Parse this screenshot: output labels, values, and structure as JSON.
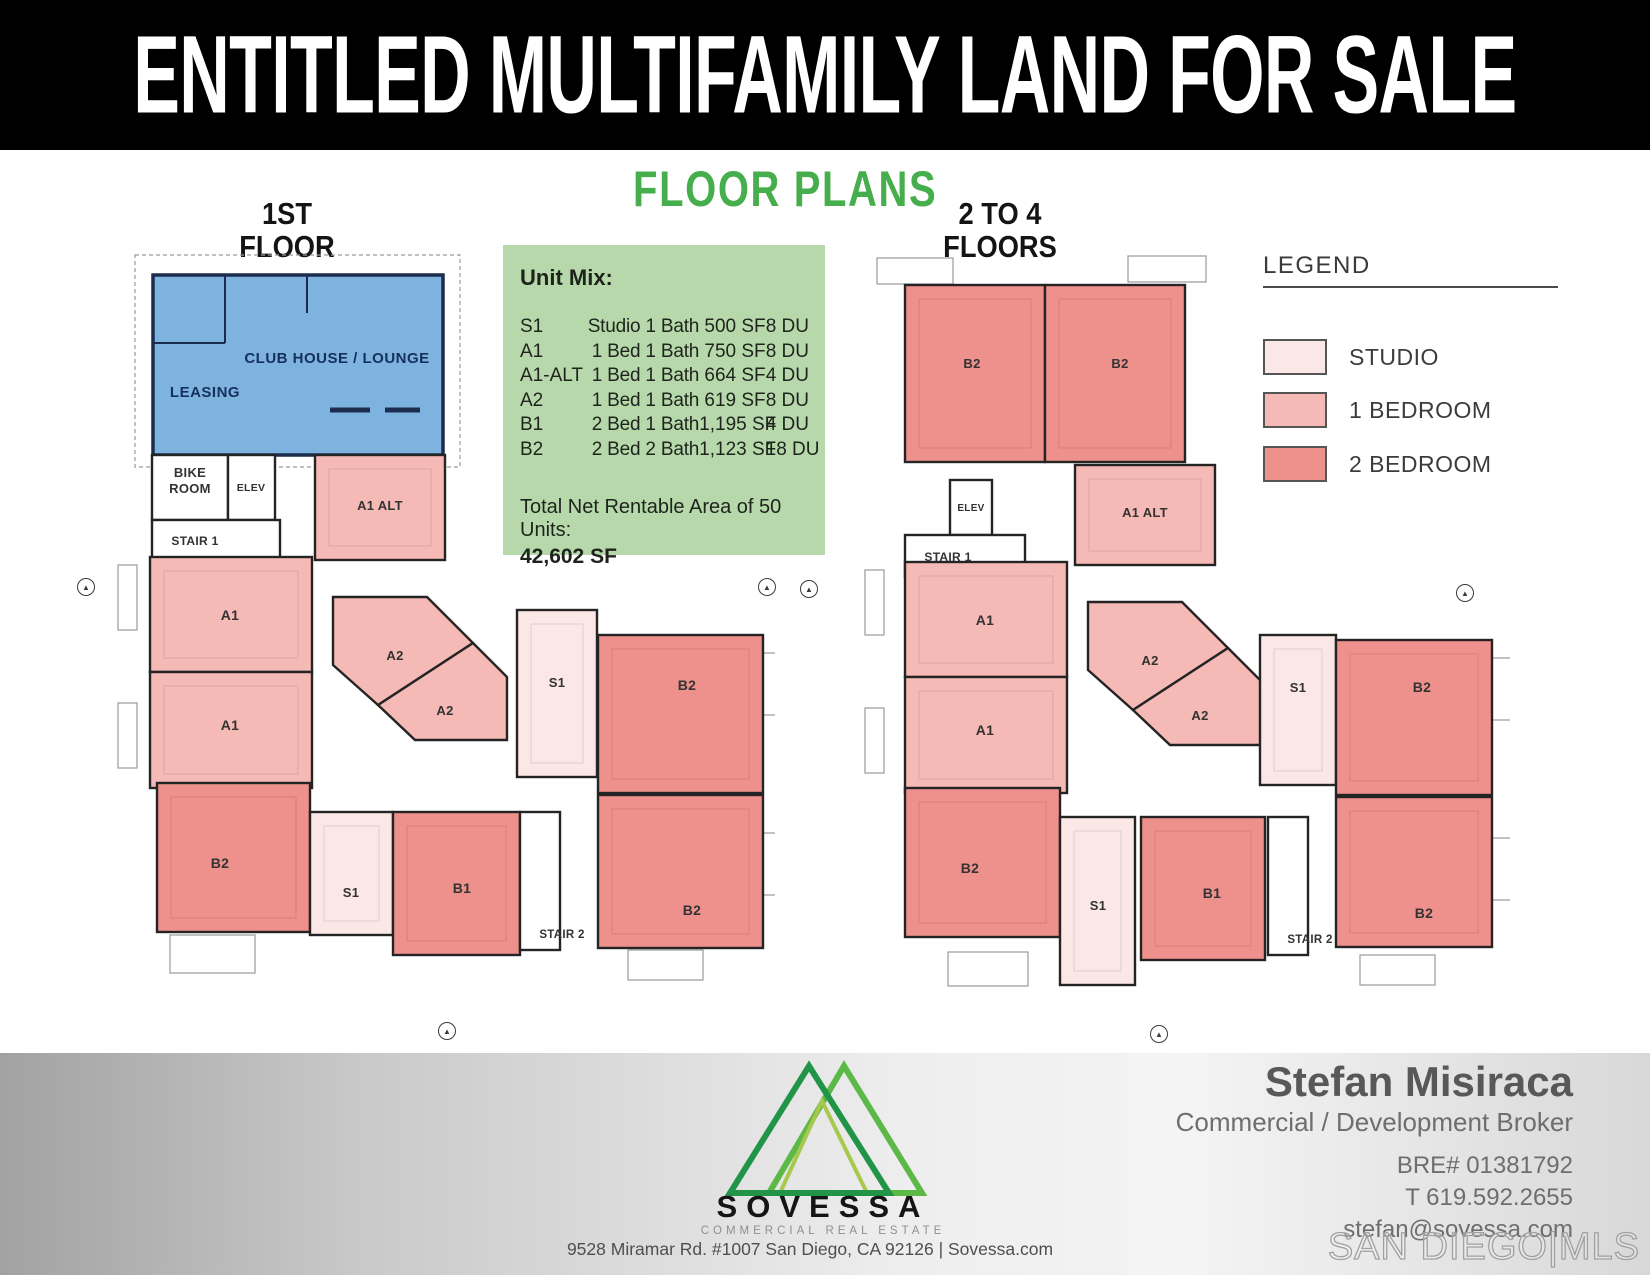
{
  "header": {
    "title": "ENTITLED MULTIFAMILY LAND FOR SALE"
  },
  "section_title": "FLOOR PLANS",
  "colors": {
    "banner_bg": "#000000",
    "banner_text": "#ffffff",
    "heading_green": "#47ae4d",
    "unit_mix_bg": "#b6d8ab",
    "studio": "#fbe7e5",
    "one_bed": "#f5b9b6",
    "two_bed": "#ee908c",
    "amenity": "#7fb3df",
    "wall": "#242424",
    "amenity_wall": "#1b2c4e",
    "common": "#ffffff"
  },
  "unit_mix": {
    "heading": "Unit Mix:",
    "rows": [
      {
        "code": "S1",
        "desc": "Studio 1 Bath",
        "sf": "500 SF",
        "du": "8 DU"
      },
      {
        "code": "A1",
        "desc": "1 Bed 1 Bath",
        "sf": "750 SF",
        "du": "8 DU"
      },
      {
        "code": "A1-ALT",
        "desc": "1 Bed 1 Bath",
        "sf": "664 SF",
        "du": "4 DU"
      },
      {
        "code": "A2",
        "desc": "1 Bed 1 Bath",
        "sf": "619 SF",
        "du": "8 DU"
      },
      {
        "code": "B1",
        "desc": "2 Bed 1 Bath",
        "sf": "1,195 SF",
        "du": "4 DU"
      },
      {
        "code": "B2",
        "desc": "2 Bed 2 Bath",
        "sf": "1,123 SF",
        "du": "18 DU"
      }
    ],
    "total_label": "Total Net Rentable Area of 50 Units:",
    "total_value": "42,602 SF"
  },
  "legend": {
    "title": "LEGEND",
    "items": [
      {
        "label": "STUDIO",
        "color": "#fbe7e5",
        "top": 51
      },
      {
        "label": "1 BEDROOM",
        "color": "#f5b9b6",
        "top": 104
      },
      {
        "label": "2 BEDROOM",
        "color": "#ee908c",
        "top": 158
      }
    ]
  },
  "plans": [
    {
      "id": "plan-first",
      "title_line1": "1ST",
      "title_line2": "FLOOR",
      "left": 75,
      "top": 235,
      "width": 700,
      "height": 770,
      "deco": [
        {
          "x": 60,
          "y": 20,
          "w": 325,
          "h": 212,
          "dashed": true
        },
        {
          "x": 43,
          "y": 330,
          "w": 19,
          "h": 65
        },
        {
          "x": 43,
          "y": 468,
          "w": 19,
          "h": 65
        },
        {
          "x": 688,
          "y": 418,
          "w": 22,
          "h": 62
        },
        {
          "x": 688,
          "y": 598,
          "w": 22,
          "h": 62
        },
        {
          "x": 95,
          "y": 700,
          "w": 85,
          "h": 38
        },
        {
          "x": 553,
          "y": 715,
          "w": 75,
          "h": 30
        }
      ],
      "lines": [
        {
          "x1": 150,
          "y1": 40,
          "x2": 150,
          "y2": 108
        },
        {
          "x1": 78,
          "y1": 108,
          "x2": 150,
          "y2": 108
        },
        {
          "x1": 232,
          "y1": 40,
          "x2": 232,
          "y2": 78
        },
        {
          "x1": 255,
          "y1": 175,
          "x2": 295,
          "y2": 175,
          "w": 5
        },
        {
          "x1": 310,
          "y1": 175,
          "x2": 345,
          "y2": 175,
          "w": 5
        }
      ],
      "texts": [
        {
          "t": "LEASING",
          "x": 130,
          "y": 162,
          "cls": "amenity",
          "fs": 15
        },
        {
          "t": "CLUB HOUSE / LOUNGE",
          "x": 262,
          "y": 128,
          "cls": "amenity",
          "fs": 15
        },
        {
          "t": "STAIR 2",
          "x": 487,
          "y": 703,
          "fs": 11.5
        }
      ],
      "rooms": [
        {
          "type": "amenity",
          "x": 78,
          "y": 40,
          "w": 290,
          "h": 180
        },
        {
          "type": "common",
          "x": 77,
          "y": 220,
          "w": 76,
          "h": 65,
          "label": "BIKE|ROOM",
          "fs": 13,
          "lx": 115,
          "ly": 242
        },
        {
          "type": "common",
          "x": 153,
          "y": 220,
          "w": 47,
          "h": 65,
          "label": "ELEV",
          "fs": 10.5,
          "lx": 176,
          "ly": 256
        },
        {
          "type": "common",
          "x": 77,
          "y": 285,
          "w": 128,
          "h": 40,
          "label": "STAIR 1",
          "fs": 12,
          "lx": 120,
          "ly": 310
        },
        {
          "type": "one_bed",
          "x": 240,
          "y": 220,
          "w": 130,
          "h": 105,
          "label": "A1 ALT",
          "fs": 13,
          "lx": 305,
          "ly": 275
        },
        {
          "type": "one_bed",
          "x": 75,
          "y": 322,
          "w": 162,
          "h": 115,
          "label": "A1",
          "fs": 14,
          "lx": 155,
          "ly": 385
        },
        {
          "type": "one_bed",
          "x": 75,
          "y": 437,
          "w": 162,
          "h": 116,
          "label": "A1",
          "fs": 14,
          "lx": 155,
          "ly": 495
        },
        {
          "type": "one_bed",
          "points": "258,362 352,362 398,408 303,470 258,430",
          "label": "A2",
          "fs": 13,
          "lx": 320,
          "ly": 425
        },
        {
          "type": "one_bed",
          "points": "398,408 432,442 432,505 340,505 303,470",
          "label": "A2",
          "fs": 13,
          "lx": 370,
          "ly": 480
        },
        {
          "type": "studio",
          "x": 442,
          "y": 375,
          "w": 80,
          "h": 167,
          "label": "S1",
          "fs": 13,
          "lx": 482,
          "ly": 452
        },
        {
          "type": "two_bed",
          "x": 523,
          "y": 400,
          "w": 165,
          "h": 158,
          "label": "B2",
          "fs": 14,
          "lx": 612,
          "ly": 455
        },
        {
          "type": "two_bed",
          "x": 523,
          "y": 560,
          "w": 165,
          "h": 153,
          "label": "B2",
          "fs": 14,
          "lx": 617,
          "ly": 680
        },
        {
          "type": "two_bed",
          "x": 82,
          "y": 548,
          "w": 153,
          "h": 149,
          "label": "B2",
          "fs": 14,
          "lx": 145,
          "ly": 633
        },
        {
          "type": "studio",
          "x": 235,
          "y": 577,
          "w": 83,
          "h": 123,
          "label": "S1",
          "fs": 13,
          "lx": 276,
          "ly": 662
        },
        {
          "type": "two_bed",
          "x": 318,
          "y": 577,
          "w": 127,
          "h": 143,
          "label": "B1",
          "fs": 14,
          "lx": 387,
          "ly": 658
        },
        {
          "type": "common",
          "x": 445,
          "y": 577,
          "w": 40,
          "h": 138
        }
      ]
    },
    {
      "id": "plan-upper",
      "title_line1": "2 TO 4",
      "title_line2": "FLOORS",
      "left": 820,
      "top": 240,
      "width": 690,
      "height": 770,
      "deco": [
        {
          "x": 57,
          "y": 18,
          "w": 76,
          "h": 26
        },
        {
          "x": 308,
          "y": 16,
          "w": 78,
          "h": 26
        },
        {
          "x": 45,
          "y": 330,
          "w": 19,
          "h": 65
        },
        {
          "x": 45,
          "y": 468,
          "w": 19,
          "h": 65
        },
        {
          "x": 672,
          "y": 418,
          "w": 22,
          "h": 62
        },
        {
          "x": 672,
          "y": 598,
          "w": 22,
          "h": 62
        },
        {
          "x": 128,
          "y": 712,
          "w": 80,
          "h": 34
        },
        {
          "x": 540,
          "y": 715,
          "w": 75,
          "h": 30
        }
      ],
      "lines": [],
      "texts": [
        {
          "t": "STAIR 2",
          "x": 490,
          "y": 703,
          "fs": 11.5
        }
      ],
      "rooms": [
        {
          "type": "two_bed",
          "x": 85,
          "y": 45,
          "w": 140,
          "h": 177,
          "label": "B2",
          "fs": 13,
          "lx": 152,
          "ly": 128
        },
        {
          "type": "two_bed",
          "x": 225,
          "y": 45,
          "w": 140,
          "h": 177,
          "label": "B2",
          "fs": 13,
          "lx": 300,
          "ly": 128
        },
        {
          "type": "common",
          "x": 130,
          "y": 240,
          "w": 42,
          "h": 55,
          "label": "ELEV",
          "fs": 10,
          "lx": 151,
          "ly": 271
        },
        {
          "type": "common",
          "x": 85,
          "y": 295,
          "w": 120,
          "h": 42,
          "label": "STAIR 1",
          "fs": 12,
          "lx": 128,
          "ly": 321
        },
        {
          "type": "one_bed",
          "x": 255,
          "y": 225,
          "w": 140,
          "h": 100,
          "label": "A1 ALT",
          "fs": 13,
          "lx": 325,
          "ly": 277
        },
        {
          "type": "one_bed",
          "x": 85,
          "y": 322,
          "w": 162,
          "h": 115,
          "label": "A1",
          "fs": 14,
          "lx": 165,
          "ly": 385
        },
        {
          "type": "one_bed",
          "x": 85,
          "y": 437,
          "w": 162,
          "h": 116,
          "label": "A1",
          "fs": 14,
          "lx": 165,
          "ly": 495
        },
        {
          "type": "one_bed",
          "points": "268,362 362,362 408,408 313,470 268,430",
          "label": "A2",
          "fs": 13,
          "lx": 330,
          "ly": 425
        },
        {
          "type": "one_bed",
          "points": "408,408 442,442 442,505 350,505 313,470",
          "label": "A2",
          "fs": 13,
          "lx": 380,
          "ly": 480
        },
        {
          "type": "studio",
          "x": 440,
          "y": 395,
          "w": 76,
          "h": 150,
          "label": "S1",
          "fs": 13,
          "lx": 478,
          "ly": 452
        },
        {
          "type": "two_bed",
          "x": 516,
          "y": 400,
          "w": 156,
          "h": 155,
          "label": "B2",
          "fs": 14,
          "lx": 602,
          "ly": 452
        },
        {
          "type": "two_bed",
          "x": 516,
          "y": 557,
          "w": 156,
          "h": 150,
          "label": "B2",
          "fs": 14,
          "lx": 604,
          "ly": 678
        },
        {
          "type": "two_bed",
          "x": 85,
          "y": 548,
          "w": 155,
          "h": 149,
          "label": "B2",
          "fs": 14,
          "lx": 150,
          "ly": 633
        },
        {
          "type": "studio",
          "x": 240,
          "y": 577,
          "w": 75,
          "h": 168,
          "label": "S1",
          "fs": 13,
          "lx": 278,
          "ly": 670
        },
        {
          "type": "two_bed",
          "x": 321,
          "y": 577,
          "w": 124,
          "h": 143,
          "label": "B1",
          "fs": 14,
          "lx": 392,
          "ly": 658
        },
        {
          "type": "common",
          "x": 448,
          "y": 577,
          "w": 40,
          "h": 138
        }
      ]
    }
  ],
  "compasses": [
    {
      "x": 77,
      "y": 578
    },
    {
      "x": 758,
      "y": 578
    },
    {
      "x": 800,
      "y": 580
    },
    {
      "x": 1456,
      "y": 584
    },
    {
      "x": 438,
      "y": 1022
    },
    {
      "x": 1150,
      "y": 1025
    }
  ],
  "footer": {
    "logo_text": "SOVESSA",
    "logo_sub": "COMMERCIAL REAL ESTATE",
    "logo_colors": {
      "left_tri": "#229447",
      "right_tri": "#5cb947",
      "inner_tri": "#a6c94d"
    },
    "address": "9528 Miramar Rd. #1007 San Diego, CA 92126  |  Sovessa.com",
    "broker": {
      "name": "Stefan Misiraca",
      "title": "Commercial / Development Broker",
      "bre": "BRE# 01381792",
      "phone": "T 619.592.2655",
      "email": "stefan@sovessa.com"
    },
    "mls": "SAN DIEGO|MLS"
  }
}
